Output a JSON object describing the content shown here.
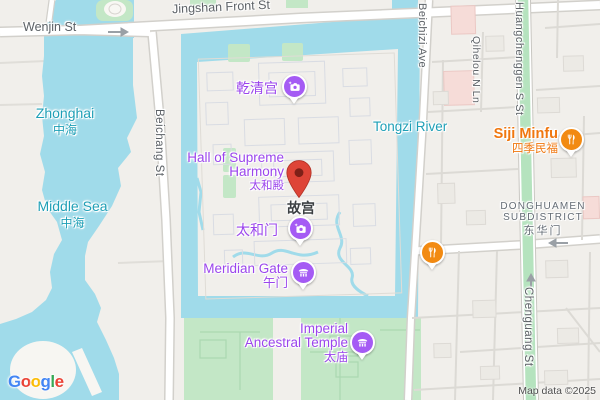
{
  "colors": {
    "water_fill": "#A0DBEA",
    "park_green": "#C3E7C6",
    "road_green": "#B5E3BE",
    "poi_purple_icon": "#A55BF4",
    "poi_purple_text": "#9B45EC",
    "destination_pin_red": "#DE4437",
    "destination_pin_inner": "#7E2018",
    "restaurant_orange": "#F28A12",
    "water_text_teal": "#1E9FB6",
    "street_text_gray": "#5C6166",
    "district_text_gray": "#646C75"
  },
  "icons": {
    "camera": "camera-icon",
    "temple": "temple-icon",
    "restaurant": "restaurant-icon",
    "destination": "destination-pin",
    "one_way_arrow": "one-way-arrow-icon"
  },
  "streets": {
    "jingshan": "Jingshan Front St",
    "wenjin": "Wenjin St",
    "beichang": "Beichang St",
    "beichizi": "Beichizi Ave",
    "qihelou": "Qihelou N Ln",
    "huangchenggen": "Huangchenggen S St",
    "chenguang": "Chenguang St"
  },
  "waters": {
    "zhonghai": {
      "en": "Zhonghai",
      "zh": "中海"
    },
    "middle_sea": {
      "en": "Middle Sea",
      "zh": "中海"
    },
    "tongzi_river": {
      "en": "Tongzi River"
    }
  },
  "pois": {
    "qianqing_palace": {
      "zh": "乾清宫"
    },
    "hall_of_supreme_harmony": {
      "en_line1": "Hall of Supreme",
      "en_line2": "Harmony",
      "zh": "太和殿"
    },
    "forbidden_city": {
      "zh": "故宫"
    },
    "gate_of_supreme_harmony": {
      "zh": "太和门"
    },
    "meridian_gate": {
      "en": "Meridian Gate",
      "zh": "午门"
    },
    "imperial_ancestral_temple": {
      "en_line1": "Imperial",
      "en_line2": "Ancestral Temple",
      "zh": "太庙"
    },
    "siji_minfu": {
      "en": "Siji Minfu",
      "zh": "四季民福"
    }
  },
  "district": {
    "line1": "DONGHUAMEN",
    "line2": "SUBDISTRICT",
    "zh": "东华门"
  },
  "logo": {
    "letters": [
      "G",
      "o",
      "o",
      "g",
      "l",
      "e"
    ]
  },
  "attribution": "Map data ©2025"
}
